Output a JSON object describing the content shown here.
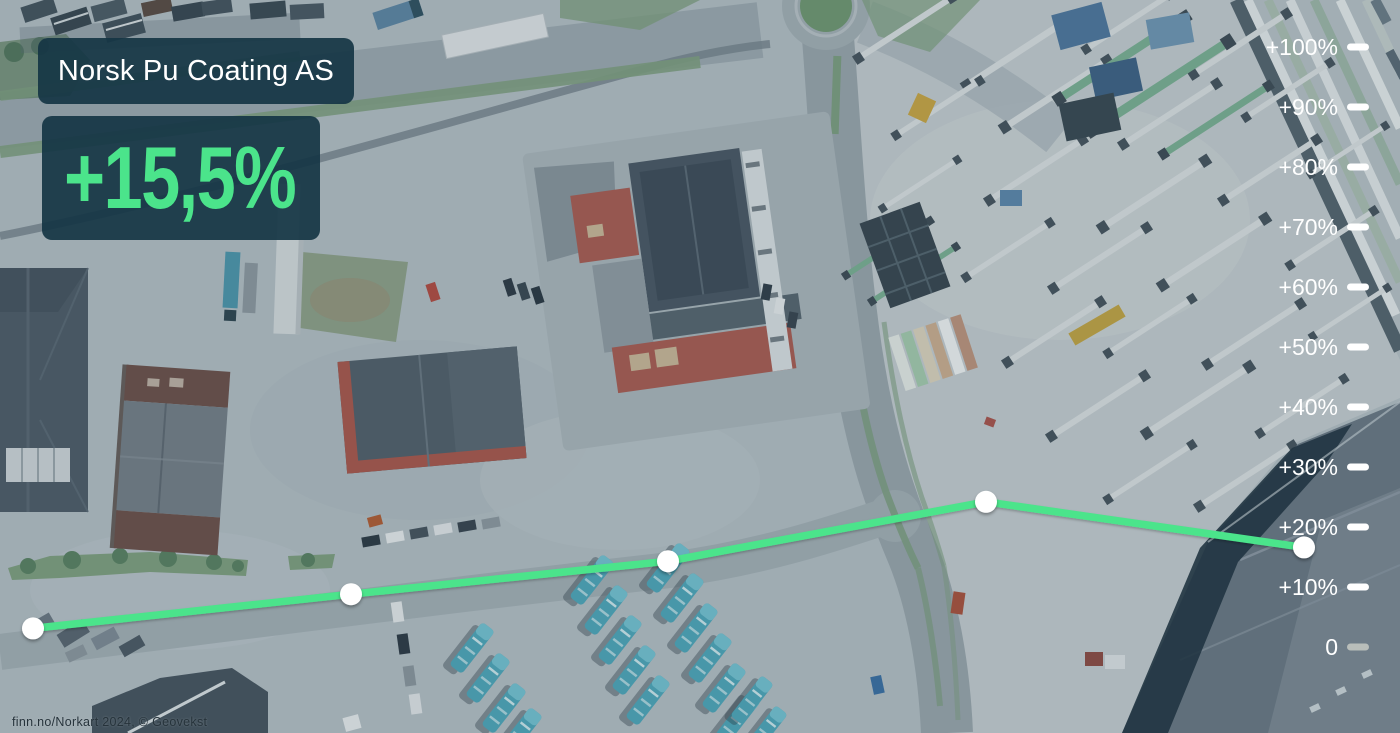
{
  "overlay": {
    "company_label": "Norsk Pu Coating AS",
    "headline_change": "+15,5%"
  },
  "colors": {
    "accent_green": "#4be48b",
    "badge_background": "rgba(21,53,68,0.92)",
    "axis_label_white": "#ffffff",
    "zero_tick_gray": "#b9beba"
  },
  "chart_data": {
    "type": "line",
    "title": "",
    "series": [
      {
        "name": "price_development_percent",
        "values": [
          3.1,
          8.8,
          14.3,
          24.2,
          16.6
        ]
      }
    ],
    "x": [
      0,
      1,
      2,
      3,
      4
    ],
    "x_pixels": [
      33,
      351,
      668,
      986,
      1304
    ],
    "y_axis": {
      "position": "right",
      "tick_labels": [
        "+100%",
        "+90%",
        "+80%",
        "+70%",
        "+60%",
        "+50%",
        "+40%",
        "+30%",
        "+20%",
        "+10%",
        "0"
      ],
      "tick_values": [
        100,
        90,
        80,
        70,
        60,
        50,
        40,
        30,
        20,
        10,
        0
      ],
      "range": [
        0,
        100
      ],
      "zero_baseline_y_px": 647,
      "px_per_percent": 6
    },
    "grid": false,
    "legend": false,
    "line_color": "#4be48b",
    "marker": {
      "shape": "circle",
      "color": "#ffffff",
      "radius": 11
    }
  },
  "attribution": "finn.no/Norkart 2024, © Geovekst"
}
